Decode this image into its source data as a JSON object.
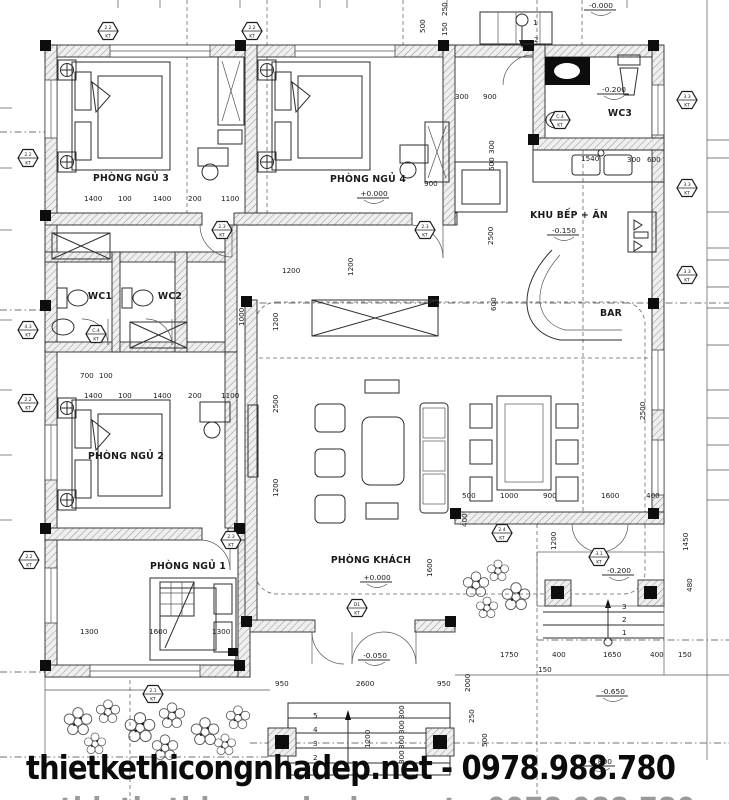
{
  "watermark": {
    "text": "thietkethicongnhadep.net - 0978.988.780"
  },
  "plan": {
    "hex_sub": "KT",
    "rooms": [
      {
        "label": "PHÒNG NGỦ 3",
        "x": 131,
        "y": 181
      },
      {
        "label": "PHÒNG NGỦ 4",
        "x": 368,
        "y": 182
      },
      {
        "label": "WC3",
        "x": 620,
        "y": 116
      },
      {
        "label": "KHU BẾP + ĂN",
        "x": 569,
        "y": 218
      },
      {
        "label": "BAR",
        "x": 611,
        "y": 316
      },
      {
        "label": "WC1",
        "x": 100,
        "y": 299
      },
      {
        "label": "WC2",
        "x": 170,
        "y": 299
      },
      {
        "label": "PHÒNG NGỦ 2",
        "x": 126,
        "y": 459
      },
      {
        "label": "PHÒNG NGỦ 1",
        "x": 188,
        "y": 569
      },
      {
        "label": "PHÒNG KHÁCH",
        "x": 371,
        "y": 563
      }
    ],
    "levels": [
      {
        "t": "-0.000",
        "x": 601,
        "y": 8
      },
      {
        "t": "+0.000",
        "x": 374,
        "y": 196
      },
      {
        "t": "-0.200",
        "x": 614,
        "y": 92
      },
      {
        "t": "-0.150",
        "x": 564,
        "y": 233
      },
      {
        "t": "+0.000",
        "x": 377,
        "y": 580
      },
      {
        "t": "-0.050",
        "x": 375,
        "y": 658
      },
      {
        "t": "-0.200",
        "x": 619,
        "y": 573
      },
      {
        "t": "-0.650",
        "x": 613,
        "y": 694
      },
      {
        "t": "-0.800",
        "x": 600,
        "y": 764
      }
    ],
    "dims": [
      {
        "t": "250",
        "x": 447,
        "y": 16,
        "r": 1
      },
      {
        "t": "500",
        "x": 425,
        "y": 33,
        "r": 1
      },
      {
        "t": "150",
        "x": 447,
        "y": 36,
        "r": 1
      },
      {
        "t": "1",
        "x": 533,
        "y": 25
      },
      {
        "t": "2",
        "x": 534,
        "y": 42
      },
      {
        "t": "1400",
        "x": 84,
        "y": 201
      },
      {
        "t": "100",
        "x": 118,
        "y": 201
      },
      {
        "t": "1400",
        "x": 153,
        "y": 201
      },
      {
        "t": "200",
        "x": 188,
        "y": 201
      },
      {
        "t": "1100",
        "x": 221,
        "y": 201
      },
      {
        "t": "300",
        "x": 455,
        "y": 99
      },
      {
        "t": "900",
        "x": 483,
        "y": 99
      },
      {
        "t": "900",
        "x": 424,
        "y": 186
      },
      {
        "t": "1200",
        "x": 282,
        "y": 273
      },
      {
        "t": "1200",
        "x": 353,
        "y": 276,
        "r": 1
      },
      {
        "t": "1540",
        "x": 581,
        "y": 161
      },
      {
        "t": "300",
        "x": 627,
        "y": 162
      },
      {
        "t": "600",
        "x": 647,
        "y": 162
      },
      {
        "t": "300",
        "x": 494,
        "y": 154,
        "r": 1
      },
      {
        "t": "600",
        "x": 494,
        "y": 171,
        "r": 1
      },
      {
        "t": "2500",
        "x": 493,
        "y": 245,
        "r": 1
      },
      {
        "t": "600",
        "x": 496,
        "y": 311,
        "r": 1
      },
      {
        "t": "1000",
        "x": 244,
        "y": 326,
        "r": 1
      },
      {
        "t": "1200",
        "x": 278,
        "y": 331,
        "r": 1
      },
      {
        "t": "2500",
        "x": 278,
        "y": 413,
        "r": 1
      },
      {
        "t": "1200",
        "x": 278,
        "y": 497,
        "r": 1
      },
      {
        "t": "700",
        "x": 80,
        "y": 378
      },
      {
        "t": "100",
        "x": 99,
        "y": 378
      },
      {
        "t": "1400",
        "x": 84,
        "y": 398
      },
      {
        "t": "100",
        "x": 118,
        "y": 398
      },
      {
        "t": "1400",
        "x": 153,
        "y": 398
      },
      {
        "t": "200",
        "x": 188,
        "y": 398
      },
      {
        "t": "1100",
        "x": 221,
        "y": 398
      },
      {
        "t": "500",
        "x": 462,
        "y": 498
      },
      {
        "t": "1000",
        "x": 500,
        "y": 498
      },
      {
        "t": "900",
        "x": 543,
        "y": 498
      },
      {
        "t": "1600",
        "x": 601,
        "y": 498
      },
      {
        "t": "400",
        "x": 646,
        "y": 498
      },
      {
        "t": "400",
        "x": 467,
        "y": 527,
        "r": 1
      },
      {
        "t": "1200",
        "x": 556,
        "y": 550,
        "r": 1
      },
      {
        "t": "1600",
        "x": 432,
        "y": 577,
        "r": 1
      },
      {
        "t": "2500",
        "x": 645,
        "y": 420,
        "r": 1
      },
      {
        "t": "1300",
        "x": 80,
        "y": 634
      },
      {
        "t": "1600",
        "x": 149,
        "y": 634
      },
      {
        "t": "1300",
        "x": 212,
        "y": 634
      },
      {
        "t": "950",
        "x": 275,
        "y": 686
      },
      {
        "t": "2600",
        "x": 356,
        "y": 686
      },
      {
        "t": "950",
        "x": 437,
        "y": 686
      },
      {
        "t": "2000",
        "x": 470,
        "y": 692,
        "r": 1
      },
      {
        "t": "5",
        "x": 313,
        "y": 718
      },
      {
        "t": "4",
        "x": 313,
        "y": 732
      },
      {
        "t": "3",
        "x": 313,
        "y": 746
      },
      {
        "t": "2",
        "x": 313,
        "y": 760
      },
      {
        "t": "1",
        "x": 313,
        "y": 774
      },
      {
        "t": "300",
        "x": 404,
        "y": 719,
        "r": 1
      },
      {
        "t": "300",
        "x": 404,
        "y": 734,
        "r": 1
      },
      {
        "t": "300",
        "x": 404,
        "y": 749,
        "r": 1
      },
      {
        "t": "300",
        "x": 404,
        "y": 764,
        "r": 1
      },
      {
        "t": "1200",
        "x": 370,
        "y": 748,
        "r": 1
      },
      {
        "t": "250",
        "x": 474,
        "y": 723,
        "r": 1
      },
      {
        "t": "500",
        "x": 487,
        "y": 747,
        "r": 1
      },
      {
        "t": "1450",
        "x": 688,
        "y": 551,
        "r": 1
      },
      {
        "t": "480",
        "x": 692,
        "y": 592,
        "r": 1
      },
      {
        "t": "1750",
        "x": 500,
        "y": 657
      },
      {
        "t": "400",
        "x": 552,
        "y": 657
      },
      {
        "t": "1650",
        "x": 603,
        "y": 657
      },
      {
        "t": "400",
        "x": 650,
        "y": 657
      },
      {
        "t": "150",
        "x": 678,
        "y": 657
      },
      {
        "t": "150",
        "x": 538,
        "y": 672
      },
      {
        "t": "3",
        "x": 622,
        "y": 609
      },
      {
        "t": "2",
        "x": 622,
        "y": 622
      },
      {
        "t": "1",
        "x": 622,
        "y": 635
      }
    ],
    "hexes": [
      {
        "t": "2.2",
        "x": 108,
        "y": 31
      },
      {
        "t": "2.2",
        "x": 252,
        "y": 31
      },
      {
        "t": "2.2",
        "x": 28,
        "y": 158
      },
      {
        "t": "4.3",
        "x": 28,
        "y": 330
      },
      {
        "t": "2.2",
        "x": 28,
        "y": 403
      },
      {
        "t": "2.2",
        "x": 29,
        "y": 560
      },
      {
        "t": "2.3",
        "x": 222,
        "y": 230
      },
      {
        "t": "2.3",
        "x": 425,
        "y": 230
      },
      {
        "t": "C.4",
        "x": 96,
        "y": 334
      },
      {
        "t": "C.4",
        "x": 560,
        "y": 120
      },
      {
        "t": "3.3",
        "x": 687,
        "y": 100
      },
      {
        "t": "3.3",
        "x": 687,
        "y": 188
      },
      {
        "t": "3.3",
        "x": 687,
        "y": 275
      },
      {
        "t": "D1",
        "x": 357,
        "y": 608
      },
      {
        "t": "2.3",
        "x": 231,
        "y": 540
      },
      {
        "t": "2.4",
        "x": 502,
        "y": 533
      },
      {
        "t": "3.1",
        "x": 599,
        "y": 557
      },
      {
        "t": "2.1",
        "x": 153,
        "y": 694
      }
    ]
  }
}
